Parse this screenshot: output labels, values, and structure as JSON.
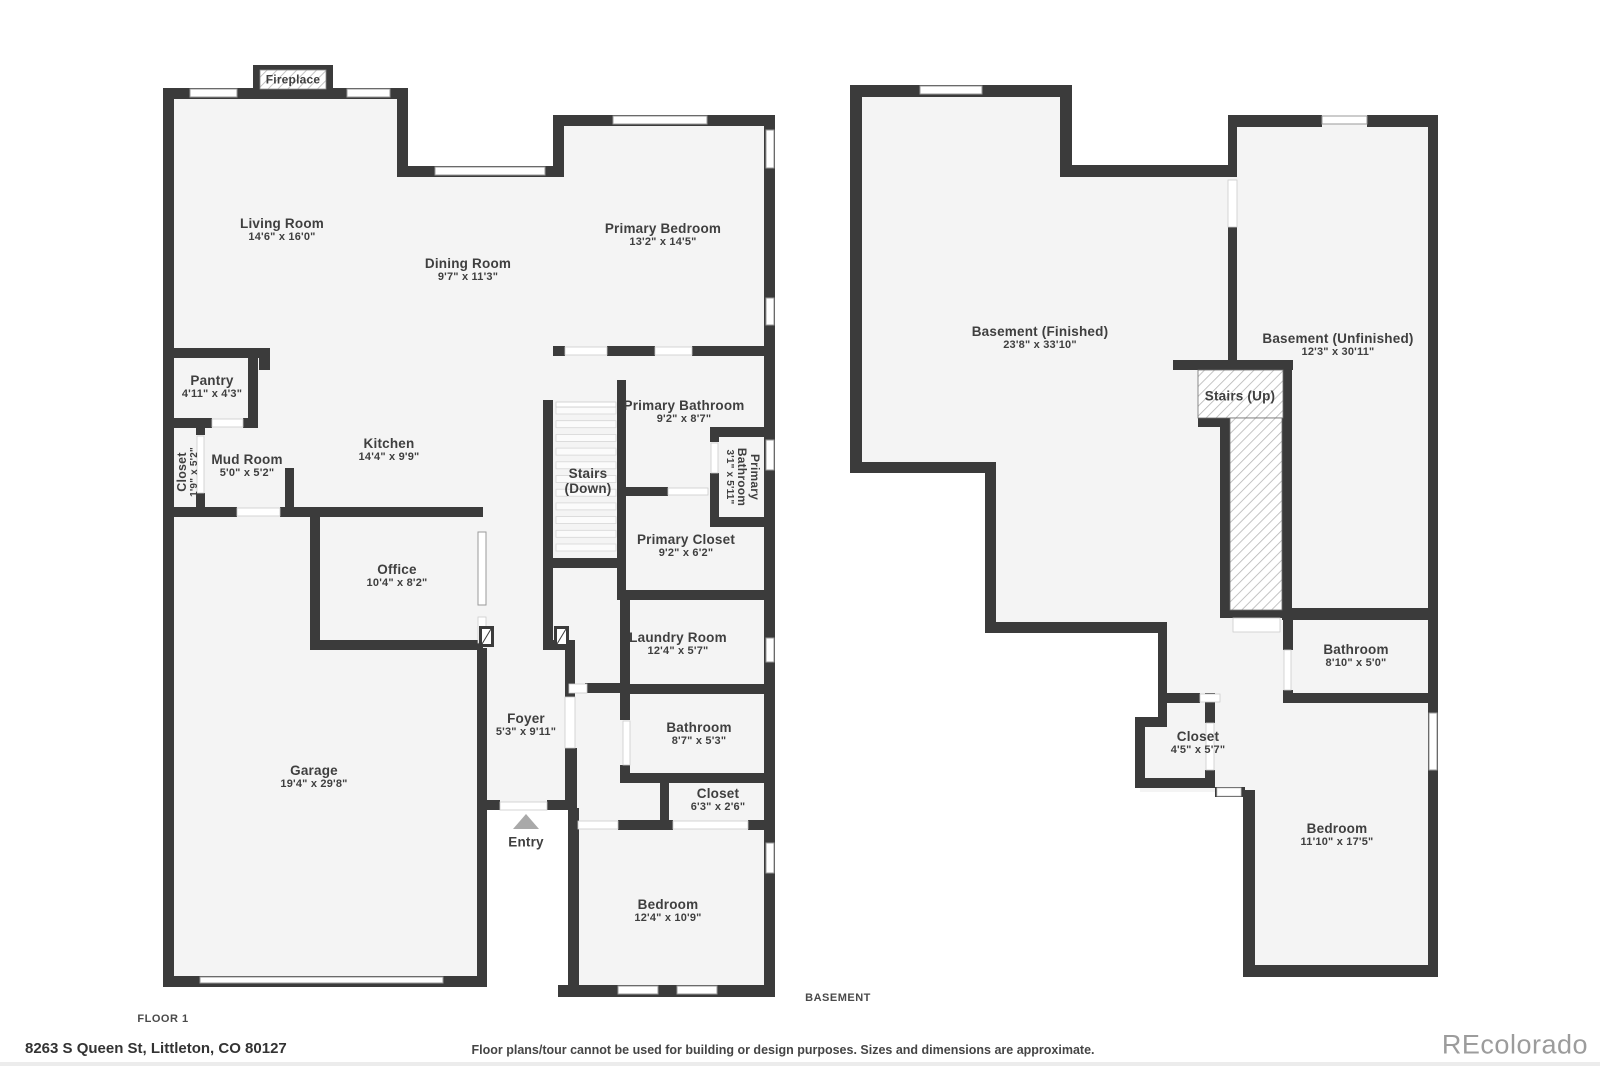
{
  "page": {
    "floor1_label": "FLOOR 1",
    "basement_label": "BASEMENT",
    "address": "8263 S Queen St, Littleton, CO 80127",
    "disclaimer": "Floor plans/tour cannot be used for building or design purposes. Sizes and dimensions are approximate.",
    "watermark": "REcolorado",
    "colors": {
      "wall": "#3b3b3b",
      "floor": "#f4f4f4",
      "label": "#3f3f3f",
      "watermark": "#9c9c9c"
    }
  },
  "floor1": {
    "fireplace": {
      "name": "Fireplace"
    },
    "living_room": {
      "name": "Living Room",
      "dims": "14'6\" x 16'0\""
    },
    "dining_room": {
      "name": "Dining Room",
      "dims": "9'7\" x 11'3\""
    },
    "primary_bedroom": {
      "name": "Primary Bedroom",
      "dims": "13'2\" x 14'5\""
    },
    "primary_bathroom": {
      "name": "Primary Bathroom",
      "dims": "9'2\" x 8'7\""
    },
    "primary_bathroom_wc": {
      "name_line1": "Primary",
      "name_line2": "Bathroom",
      "dims": "3'1\" x 5'11\""
    },
    "stairs_down": {
      "line1": "Stairs",
      "line2": "(Down)"
    },
    "primary_closet": {
      "name": "Primary Closet",
      "dims": "9'2\" x 6'2\""
    },
    "laundry_room": {
      "name": "Laundry Room",
      "dims": "12'4\" x 5'7\""
    },
    "bathroom": {
      "name": "Bathroom",
      "dims": "8'7\" x 5'3\""
    },
    "closet_hall": {
      "name": "Closet",
      "dims": "6'3\" x 2'6\""
    },
    "bedroom": {
      "name": "Bedroom",
      "dims": "12'4\" x 10'9\""
    },
    "kitchen": {
      "name": "Kitchen",
      "dims": "14'4\" x 9'9\""
    },
    "mud_room": {
      "name": "Mud Room",
      "dims": "5'0\" x 5'2\""
    },
    "closet_left": {
      "name": "Closet",
      "dims": "1'9\" x 5'2\""
    },
    "pantry": {
      "name": "Pantry",
      "dims": "4'11\" x 4'3\""
    },
    "office": {
      "name": "Office",
      "dims": "10'4\" x 8'2\""
    },
    "garage": {
      "name": "Garage",
      "dims": "19'4\" x 29'8\""
    },
    "foyer": {
      "name": "Foyer",
      "dims": "5'3\" x 9'11\""
    },
    "entry": {
      "name": "Entry"
    }
  },
  "basement": {
    "finished": {
      "name": "Basement (Finished)",
      "dims": "23'8\" x 33'10\""
    },
    "unfinished": {
      "name": "Basement (Unfinished)",
      "dims": "12'3\" x 30'11\""
    },
    "stairs_up": {
      "name": "Stairs (Up)"
    },
    "bathroom": {
      "name": "Bathroom",
      "dims": "8'10\" x 5'0\""
    },
    "closet": {
      "name": "Closet",
      "dims": "4'5\" x 5'7\""
    },
    "bedroom": {
      "name": "Bedroom",
      "dims": "11'10\" x 17'5\""
    }
  }
}
